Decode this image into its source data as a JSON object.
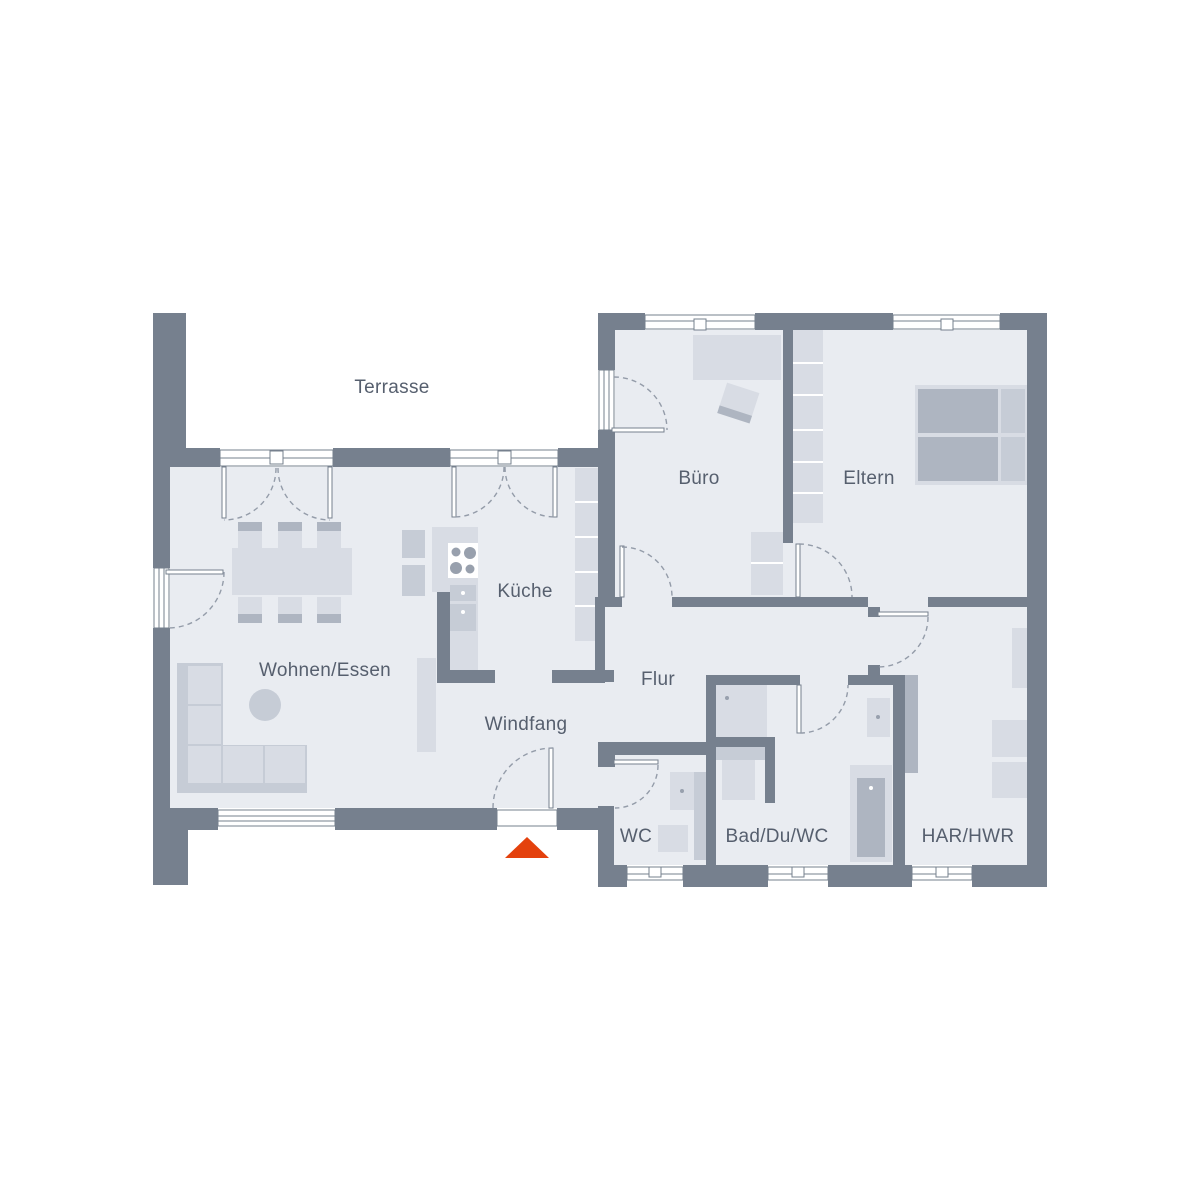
{
  "rooms": {
    "terrasse": "Terrasse",
    "buero": "Büro",
    "eltern": "Eltern",
    "kueche": "Küche",
    "wohnen_essen": "Wohnen/Essen",
    "flur": "Flur",
    "windfang": "Windfang",
    "wc": "WC",
    "bad": "Bad/Du/WC",
    "har": "HAR/HWR"
  },
  "colors": {
    "wall": "#76808E",
    "room_fill": "#E9ECF1",
    "furniture_light": "#D8DCE4",
    "furniture_medium": "#C6CCD6",
    "furniture_dark": "#AEB5C1",
    "label_text": "#565F6E",
    "door_arc": "#949CA9",
    "entrance_arrow": "#E4410D",
    "background": "#FFFFFF"
  },
  "icons": {
    "entrance_marker": "entrance-arrow"
  }
}
